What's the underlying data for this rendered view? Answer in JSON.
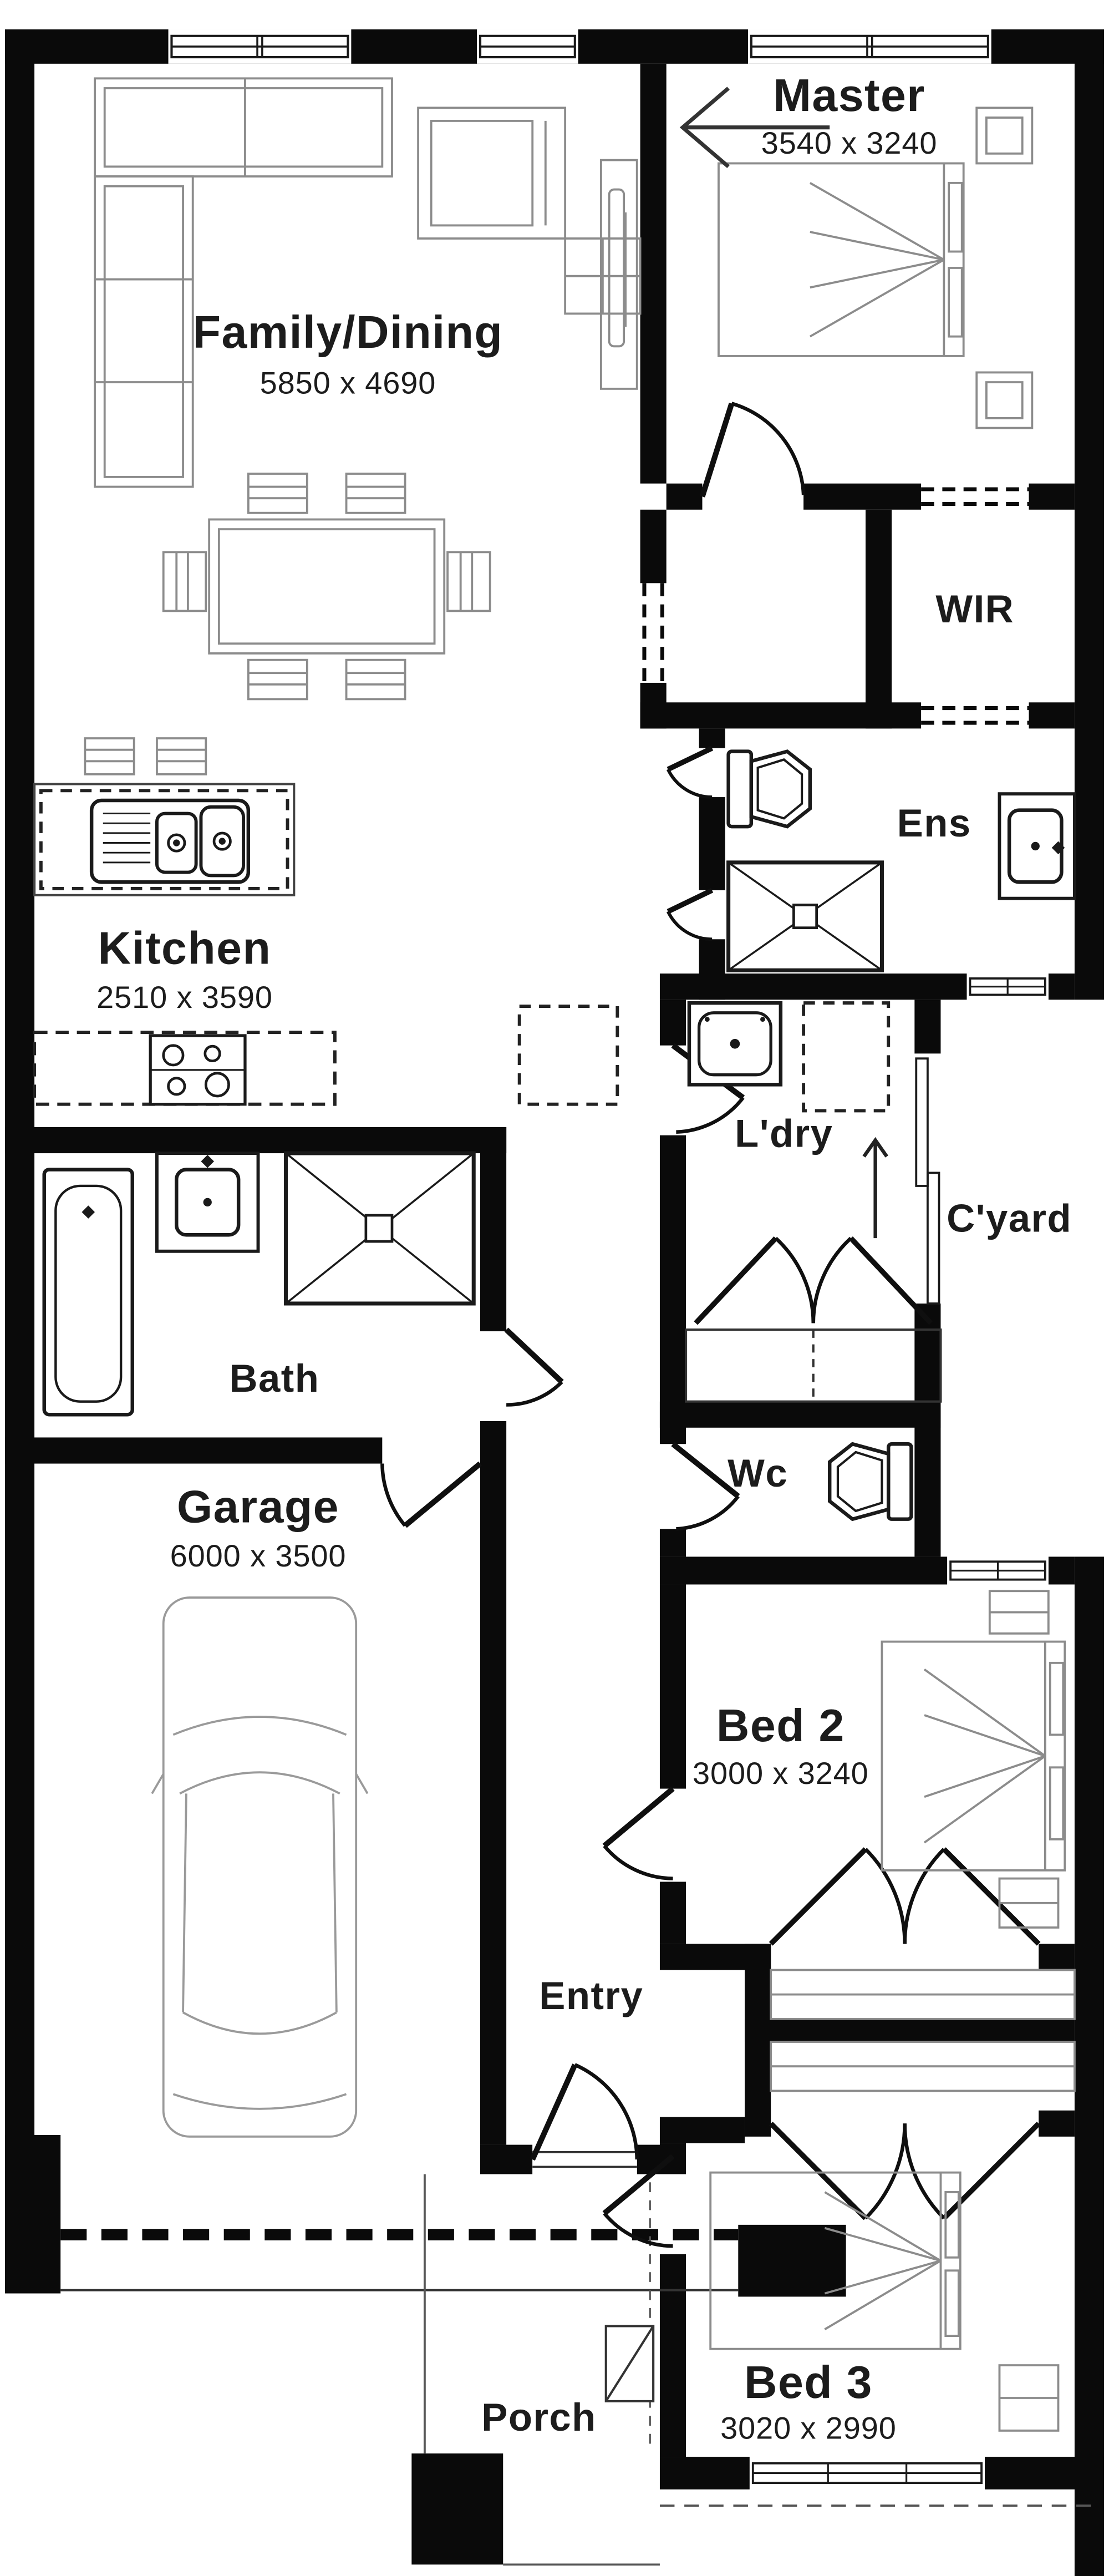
{
  "plan": {
    "wall_color": "#0a0a0a",
    "furniture_color": "#8c8c8c",
    "fixture_color": "#1a1a1a",
    "background": "#ffffff",
    "rooms": {
      "family": {
        "label": "Family/Dining",
        "dims": "5850 x 4690"
      },
      "master": {
        "label": "Master",
        "dims": "3540 x 3240"
      },
      "wir": {
        "label": "WIR"
      },
      "ens": {
        "label": "Ens"
      },
      "kitchen": {
        "label": "Kitchen",
        "dims": "2510 x 3590"
      },
      "ldry": {
        "label": "L'dry"
      },
      "cyard": {
        "label": "C'yard"
      },
      "bath": {
        "label": "Bath"
      },
      "wc": {
        "label": "Wc"
      },
      "garage": {
        "label": "Garage",
        "dims": "6000 x 3500"
      },
      "bed2": {
        "label": "Bed 2",
        "dims": "3000 x 3240"
      },
      "entry": {
        "label": "Entry"
      },
      "bed3": {
        "label": "Bed 3",
        "dims": "3020 x 2990"
      },
      "porch": {
        "label": "Porch"
      }
    }
  }
}
